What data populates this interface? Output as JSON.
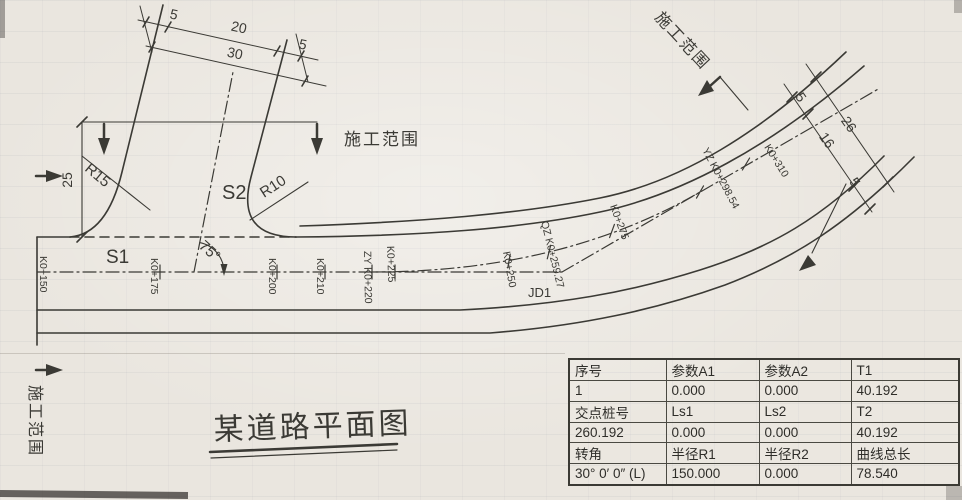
{
  "drawing": {
    "title": "某道路平面图",
    "labels": {
      "construction_scope": "施工范围",
      "s1": "S1",
      "s2": "S2",
      "r15": "R15",
      "r10": "R10",
      "angle_75": "75°",
      "jd1": "JD1"
    },
    "dims": {
      "branch_left_5": "5",
      "branch_20": "20",
      "branch_30": "30",
      "branch_right_5": "5",
      "left_25": "25",
      "right_top_5": "5",
      "right_16": "16",
      "right_26": "26",
      "right_bottom_5": "5"
    },
    "stations": [
      {
        "label": "K0+150"
      },
      {
        "label": "K0+175"
      },
      {
        "label": "K0+200"
      },
      {
        "label": "K0+210"
      },
      {
        "label": "ZY K0+220"
      },
      {
        "label": "K0+225"
      },
      {
        "label": "K0+250"
      },
      {
        "label": "QZ K0+259.27"
      },
      {
        "label": "K0+275"
      },
      {
        "label": "YZ K0+298.54"
      },
      {
        "label": "K0+310"
      }
    ]
  },
  "table": {
    "rows": [
      [
        "序号",
        "参数A1",
        "参数A2",
        "T1"
      ],
      [
        "1",
        "0.000",
        "0.000",
        "40.192"
      ],
      [
        "交点桩号",
        "Ls1",
        "Ls2",
        "T2"
      ],
      [
        "260.192",
        "0.000",
        "0.000",
        "40.192"
      ],
      [
        "转角",
        "半径R1",
        "半径R2",
        "曲线总长"
      ],
      [
        "30° 0′ 0″ (L)",
        "150.000",
        "0.000",
        "78.540"
      ]
    ]
  },
  "colors": {
    "ink": "#3b3a35",
    "paper": "#eae6df"
  }
}
